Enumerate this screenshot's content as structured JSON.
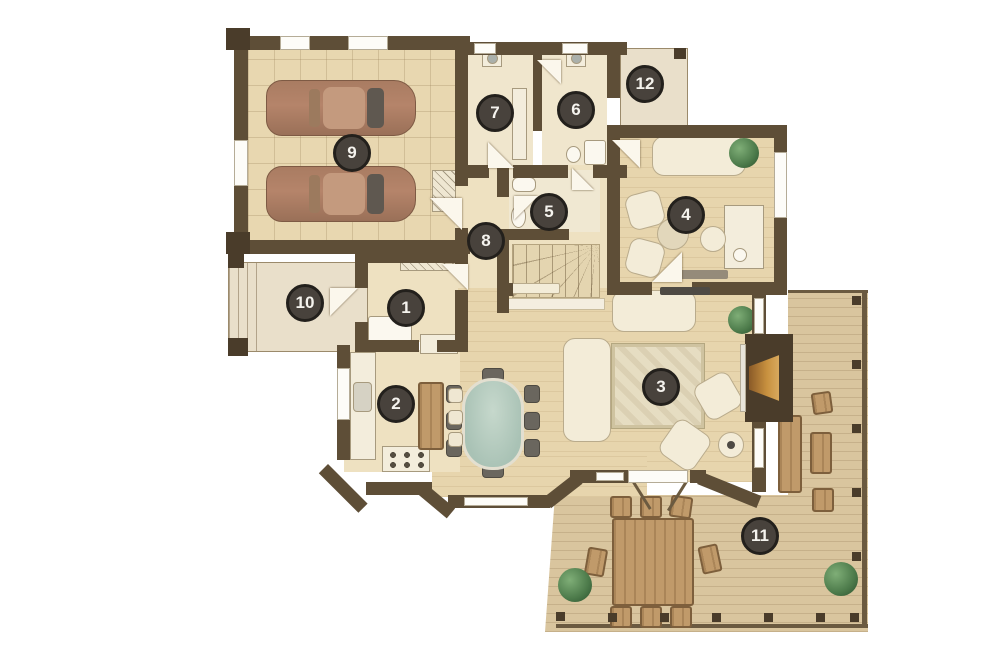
{
  "palette": {
    "wall": "#5e4e37",
    "wall_dark": "#4a3c2a",
    "floor": "#eee1c1",
    "floor_tile": "#e8d7b0",
    "floor_room": "#f0e6cd",
    "wood": "#e7d5ad",
    "deck": "#d9c59e",
    "porch": "#e9dfca",
    "window_white": "#fdfcf8",
    "frame": "#9b8a6b",
    "badge": "#48423c",
    "badge_ring": "#23201c",
    "badge_text": "#f5f3ee",
    "car": "#b5846a",
    "car_dark": "#7e5a44",
    "rug": "#e6ddc2",
    "glass": "#a9c2b5",
    "plant": "#4c7a4a",
    "cream": "#f3ecd8",
    "cream_border": "#b9ab8c",
    "outdoor": "#c09a6a",
    "outdoor_dark": "#7d5f3c",
    "appliance": "#f3eddc",
    "gray_item": "#6a665e"
  },
  "badges": [
    {
      "number": "1",
      "x": 406,
      "y": 308
    },
    {
      "number": "2",
      "x": 396,
      "y": 404
    },
    {
      "number": "3",
      "x": 661,
      "y": 387
    },
    {
      "number": "4",
      "x": 686,
      "y": 215
    },
    {
      "number": "5",
      "x": 549,
      "y": 212
    },
    {
      "number": "6",
      "x": 576,
      "y": 110
    },
    {
      "number": "7",
      "x": 495,
      "y": 113
    },
    {
      "number": "8",
      "x": 486,
      "y": 241
    },
    {
      "number": "9",
      "x": 352,
      "y": 153
    },
    {
      "number": "10",
      "x": 305,
      "y": 303
    },
    {
      "number": "11",
      "x": 760,
      "y": 536
    },
    {
      "number": "12",
      "x": 645,
      "y": 84
    }
  ]
}
